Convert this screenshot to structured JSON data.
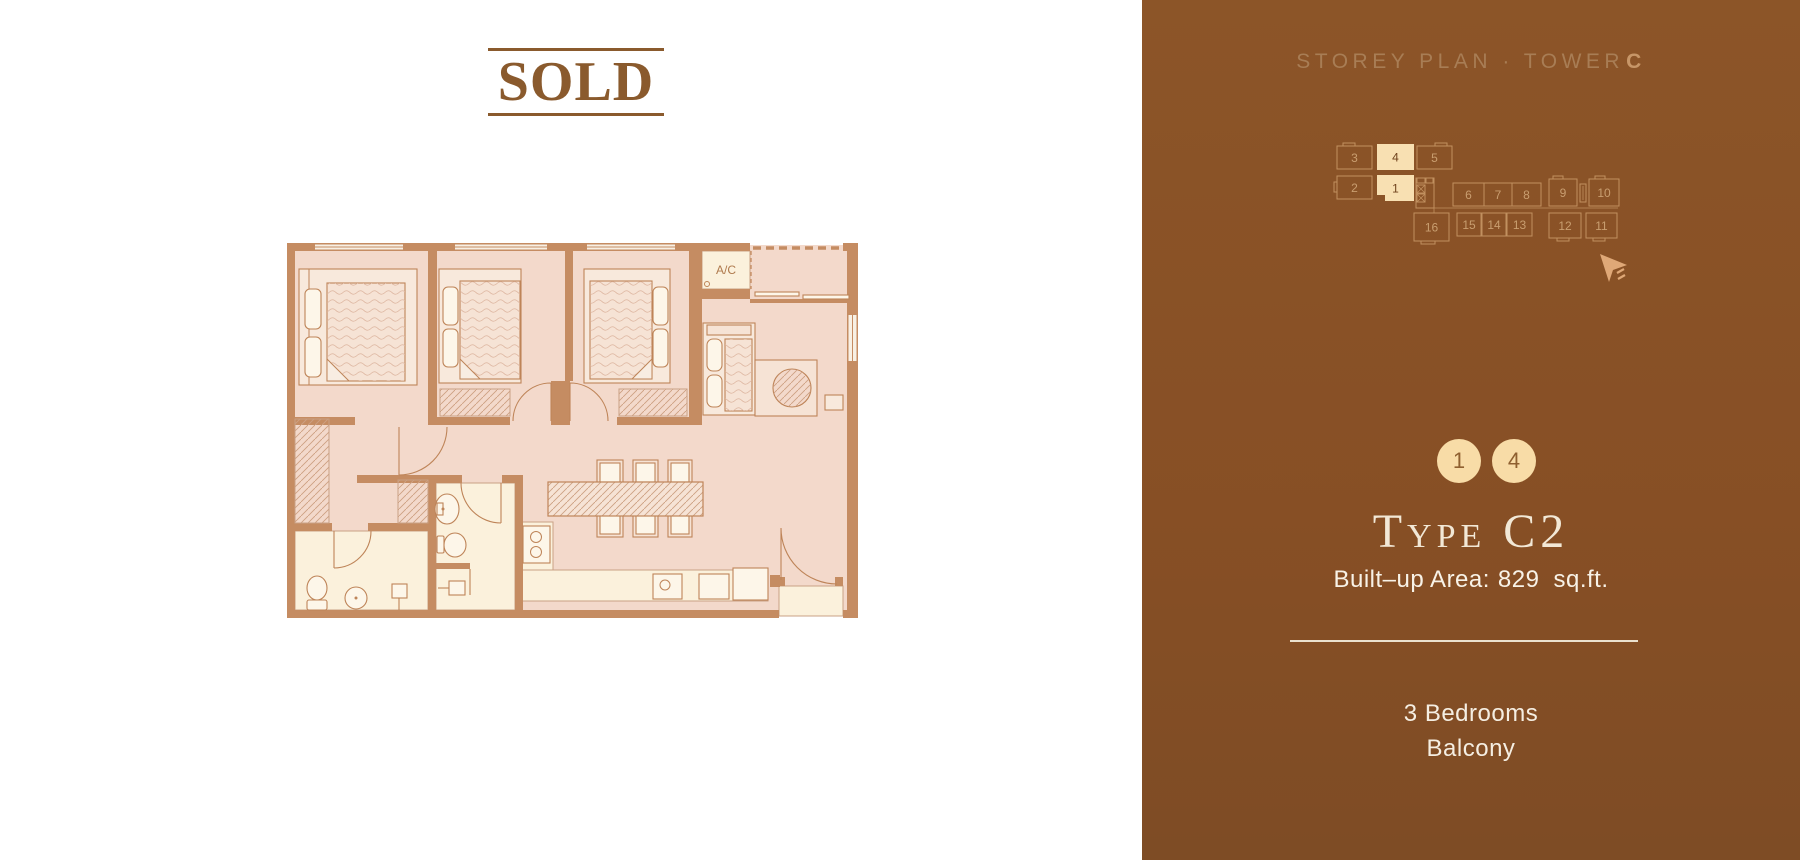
{
  "colors": {
    "panel_brown": "#8A5327",
    "sold_brown": "#8A5A2D",
    "header_text": "#A87D55",
    "header_accent": "#C79668",
    "storey_outline": "#C1905F",
    "storey_number": "#C99E70",
    "storey_highlight_fill": "#F8E0B2",
    "storey_highlight_number": "#6F421C",
    "badge_fill": "#F8DCA7",
    "badge_text": "#8F6030",
    "title_cream": "#F2E8D6",
    "body_text": "#F7F1E5",
    "divider": "#EBE1CE",
    "plan_wall": "#C58C62",
    "plan_floor": "#F3D9CB",
    "plan_cream": "#FBF1DC",
    "cursor": "#DFA877"
  },
  "left_panel": {
    "sold_label": "SOLD",
    "floor_plan": {
      "ac_label": "A/C"
    }
  },
  "right_panel": {
    "header": {
      "prefix": "STOREY PLAN · TOWER",
      "tower": "C"
    },
    "storey_plan": {
      "units": [
        {
          "label": "3",
          "highlighted": false
        },
        {
          "label": "4",
          "highlighted": true
        },
        {
          "label": "5",
          "highlighted": false
        },
        {
          "label": "2",
          "highlighted": false
        },
        {
          "label": "1",
          "highlighted": true
        },
        {
          "label": "6",
          "highlighted": false
        },
        {
          "label": "7",
          "highlighted": false
        },
        {
          "label": "8",
          "highlighted": false
        },
        {
          "label": "9",
          "highlighted": false
        },
        {
          "label": "10",
          "highlighted": false
        },
        {
          "label": "16",
          "highlighted": false
        },
        {
          "label": "15",
          "highlighted": false
        },
        {
          "label": "14",
          "highlighted": false
        },
        {
          "label": "13",
          "highlighted": false
        },
        {
          "label": "12",
          "highlighted": false
        },
        {
          "label": "11",
          "highlighted": false
        }
      ]
    },
    "selected_units": [
      "1",
      "4"
    ],
    "type_title": "Type C2",
    "built_up": {
      "label": "Built–up Area:",
      "value": "829",
      "unit": "sq.ft."
    },
    "features": [
      "3 Bedrooms",
      "Balcony"
    ]
  }
}
